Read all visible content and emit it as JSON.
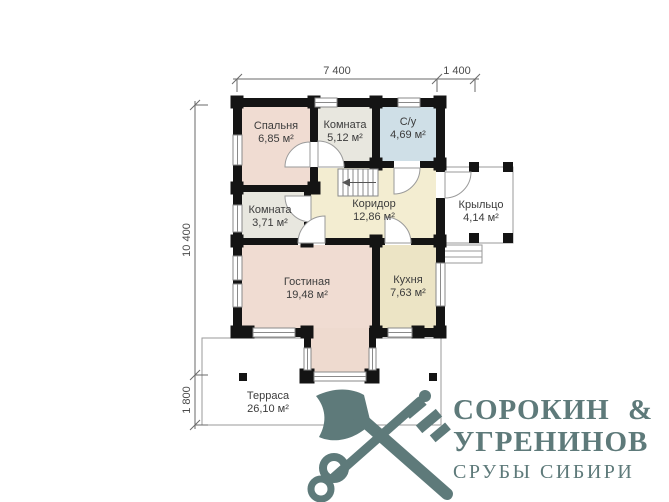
{
  "plan": {
    "rooms": [
      {
        "name": "Спальня",
        "area": "6,85 м²"
      },
      {
        "name": "Комната",
        "area": "5,12 м²"
      },
      {
        "name": "С/у",
        "area": "4,69 м²"
      },
      {
        "name": "Комната",
        "area": "3,71 м²"
      },
      {
        "name": "Коридор",
        "area": "12,86 м²"
      },
      {
        "name": "Крыльцо",
        "area": "4,14 м²"
      },
      {
        "name": "Гостиная",
        "area": "19,48 м²"
      },
      {
        "name": "Кухня",
        "area": "7,63 м²"
      },
      {
        "name": "Терраса",
        "area": "26,10 м²"
      }
    ],
    "dimensions": {
      "width_main": "7 400",
      "width_porch": "1 400",
      "height_main": "10 400",
      "depth_terrace": "1 800"
    },
    "colors": {
      "bedroom": "#f0dcd2",
      "room": "#e8e7df",
      "bathroom": "#cfdfe7",
      "corridor": "#f3edd1",
      "living": "#f0dcd2",
      "kitchen": "#ece4c5",
      "bay": "#eedacf",
      "wall": "#141414",
      "logo": "#5e7a7a"
    }
  },
  "logo": {
    "line1": "СОРОКИН &",
    "line2": "УГРЕНИНОВ",
    "line3": "СРУБЫ СИБИРИ"
  }
}
